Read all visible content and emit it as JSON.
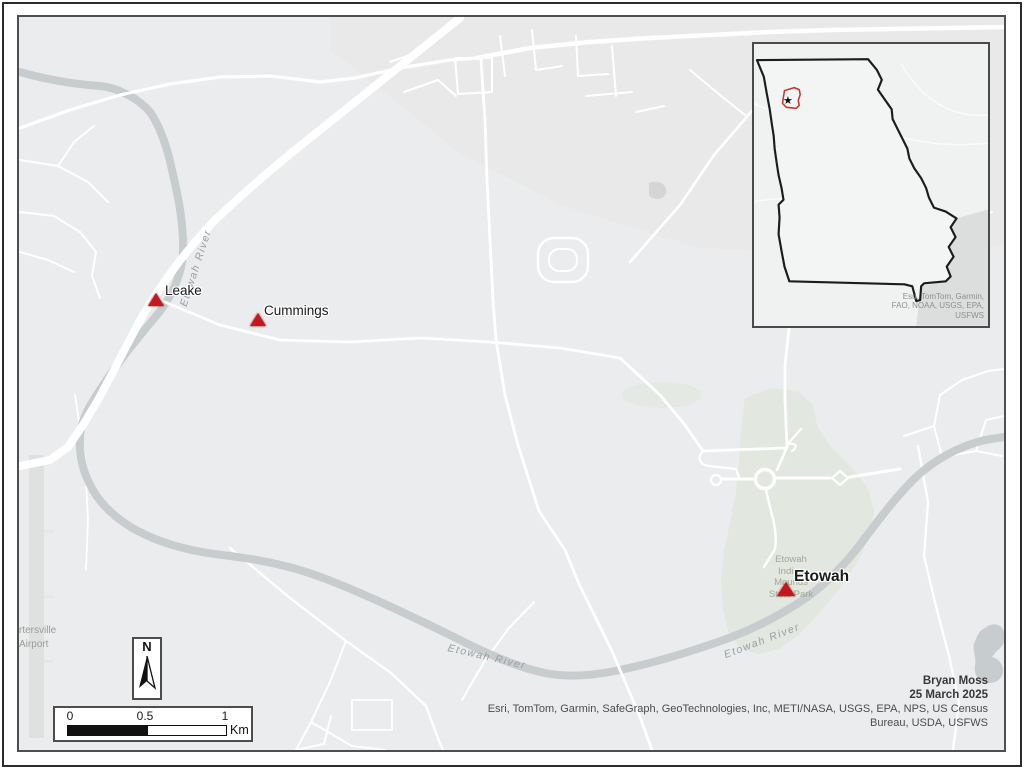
{
  "sites": [
    {
      "name": "Leake"
    },
    {
      "name": "Cummings"
    },
    {
      "name": "Etowah"
    }
  ],
  "labels": {
    "river": "Etowah River",
    "park_lines": [
      "Etowah",
      "Indian",
      "Mounds",
      "State Park"
    ],
    "airport_lines": [
      "rtersville",
      "Airport"
    ]
  },
  "north_arrow": {
    "letter": "N"
  },
  "scale_bar": {
    "tick_0": "0",
    "tick_mid": "0.5",
    "tick_1": "1",
    "unit": "Km"
  },
  "credits": {
    "author": "Bryan Moss",
    "date": "25 March 2025",
    "attribution_line_1": "Esri, TomTom, Garmin, SafeGraph, GeoTechnologies, Inc, METI/NASA, USGS, EPA, NPS, US Census",
    "attribution_line_2": "Bureau, USDA, USFWS"
  },
  "inset": {
    "attribution_lines": [
      "Esri, TomTom, Garmin,",
      "FAO, NOAA, USGS, EPA,",
      "USFWS"
    ],
    "star": "★"
  },
  "colors": {
    "marker_red": "#c4181d",
    "water_gray": "#c7ccce",
    "road_white": "#ffffff",
    "background_gray": "#ebeced",
    "park_green": "#e2e7df",
    "frame_gray": "#4f4f4f",
    "extent_red": "#c23b33",
    "state_outline": "#1c1c1c"
  }
}
